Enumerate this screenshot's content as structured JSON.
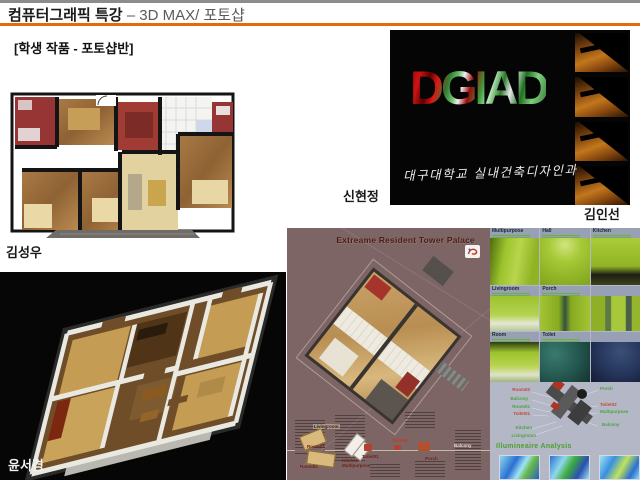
{
  "header": {
    "title_bold": "컴퓨터그래픽 특강",
    "title_rest": "– 3D MAX/ 포토샵",
    "subtitle": "[학생 작품 - 포토샵반]"
  },
  "students": {
    "floorplan2d": "김성우",
    "dgiad_left": "신현정",
    "dgiad_right": "김인선",
    "iso3d": "윤서경"
  },
  "dgiad": {
    "wordmark": "DGIAD",
    "caption": "대구대학교 실내건축디자인과"
  },
  "poster": {
    "title": "Extreame Resident Tower Palace",
    "callouts": {
      "livingroom": "Livingroom",
      "room01": "Room01",
      "room02": "Room02",
      "kitchen": "Kitchen",
      "multipurpose": "Multipurpose",
      "toilet01": "Toilet01",
      "toilet02": "Toilet02",
      "porch": "Porch",
      "balcony": "Balcony"
    }
  },
  "greenboard": {
    "cells": [
      {
        "label": "Multipurpose"
      },
      {
        "label": "Hall"
      },
      {
        "label": "Kitchen"
      },
      {
        "label": "Livingroom"
      },
      {
        "label": "Porch"
      },
      {
        "label": ""
      },
      {
        "label": "Room"
      },
      {
        "label": "Toilet"
      },
      {
        "label": ""
      }
    ],
    "diagram": {
      "left": [
        "Room02",
        "Balcony",
        "Room01",
        "Toilet01",
        "Kitchen",
        "Livingroom"
      ],
      "right": [
        "Porch",
        "Toilet02",
        "Multipurpose",
        "Balcony"
      ]
    },
    "analysis_title": "Illumineaire Analysis"
  },
  "colors": {
    "accent_orange": "#e36b0c",
    "lime_green": "#a3c32d",
    "poster_mauve": "#7d6566",
    "board_lavender": "#b4b7c6"
  }
}
